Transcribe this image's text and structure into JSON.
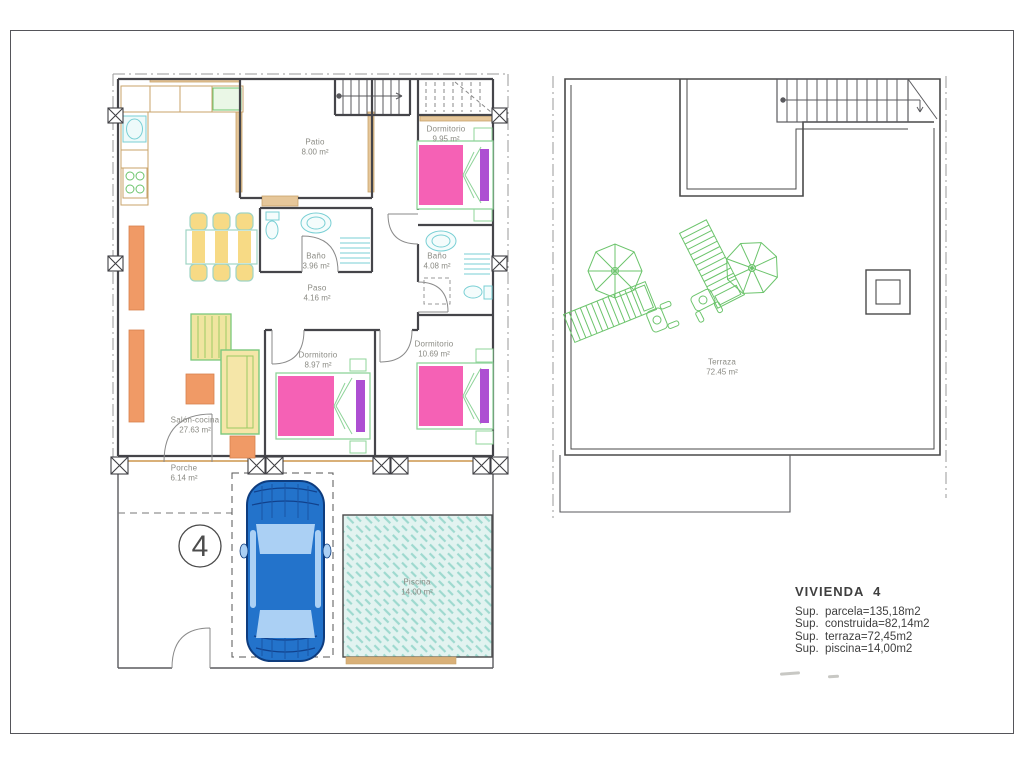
{
  "unit_circle": {
    "number": "4"
  },
  "ground_floor": {
    "rooms": [
      {
        "label": "Patio",
        "area": "8.00 m²"
      },
      {
        "label": "Dormitorio",
        "area": "9.95 m²"
      },
      {
        "label": "Baño",
        "area": "3.96 m²"
      },
      {
        "label": "Baño",
        "area": "4.08 m²"
      },
      {
        "label": "Paso",
        "area": "4.16 m²"
      },
      {
        "label": "Dormitorio",
        "area": "8.97 m²"
      },
      {
        "label": "Dormitorio",
        "area": "10.69 m²"
      },
      {
        "label": "Salón-cocina",
        "area": "27.63 m²"
      },
      {
        "label": "Porche",
        "area": "6.14 m²"
      },
      {
        "label": "Piscina",
        "area": "14.00 m²"
      }
    ]
  },
  "roof": {
    "rooms": [
      {
        "label": "Terraza",
        "area": "72.45 m²"
      }
    ]
  },
  "summary": {
    "title": "VIVIENDA  4",
    "lines": [
      "Sup.  parcela=135,18m2",
      "Sup.  construida=82,14m2",
      "Sup.  terraza=72,45m2",
      "Sup.  piscina=14,00m2"
    ]
  },
  "colors": {
    "wall": "#45454a",
    "parcel_line": "#9a9a9a",
    "bed_pink": "#f561b5",
    "bed_purple": "#ad4fd2",
    "furniture_orange": "#f09a66",
    "furniture_yellow": "#f7da85",
    "garden_green": "#6cc46c",
    "fixture_cyan": "#79cfd4",
    "window_tan": "#d9b078",
    "pool_fill": "#e2f3f0",
    "pool_hatch": "#9ed9cf",
    "car_body_blue": "#2373cb",
    "car_glass_blue": "#abd0f4"
  }
}
